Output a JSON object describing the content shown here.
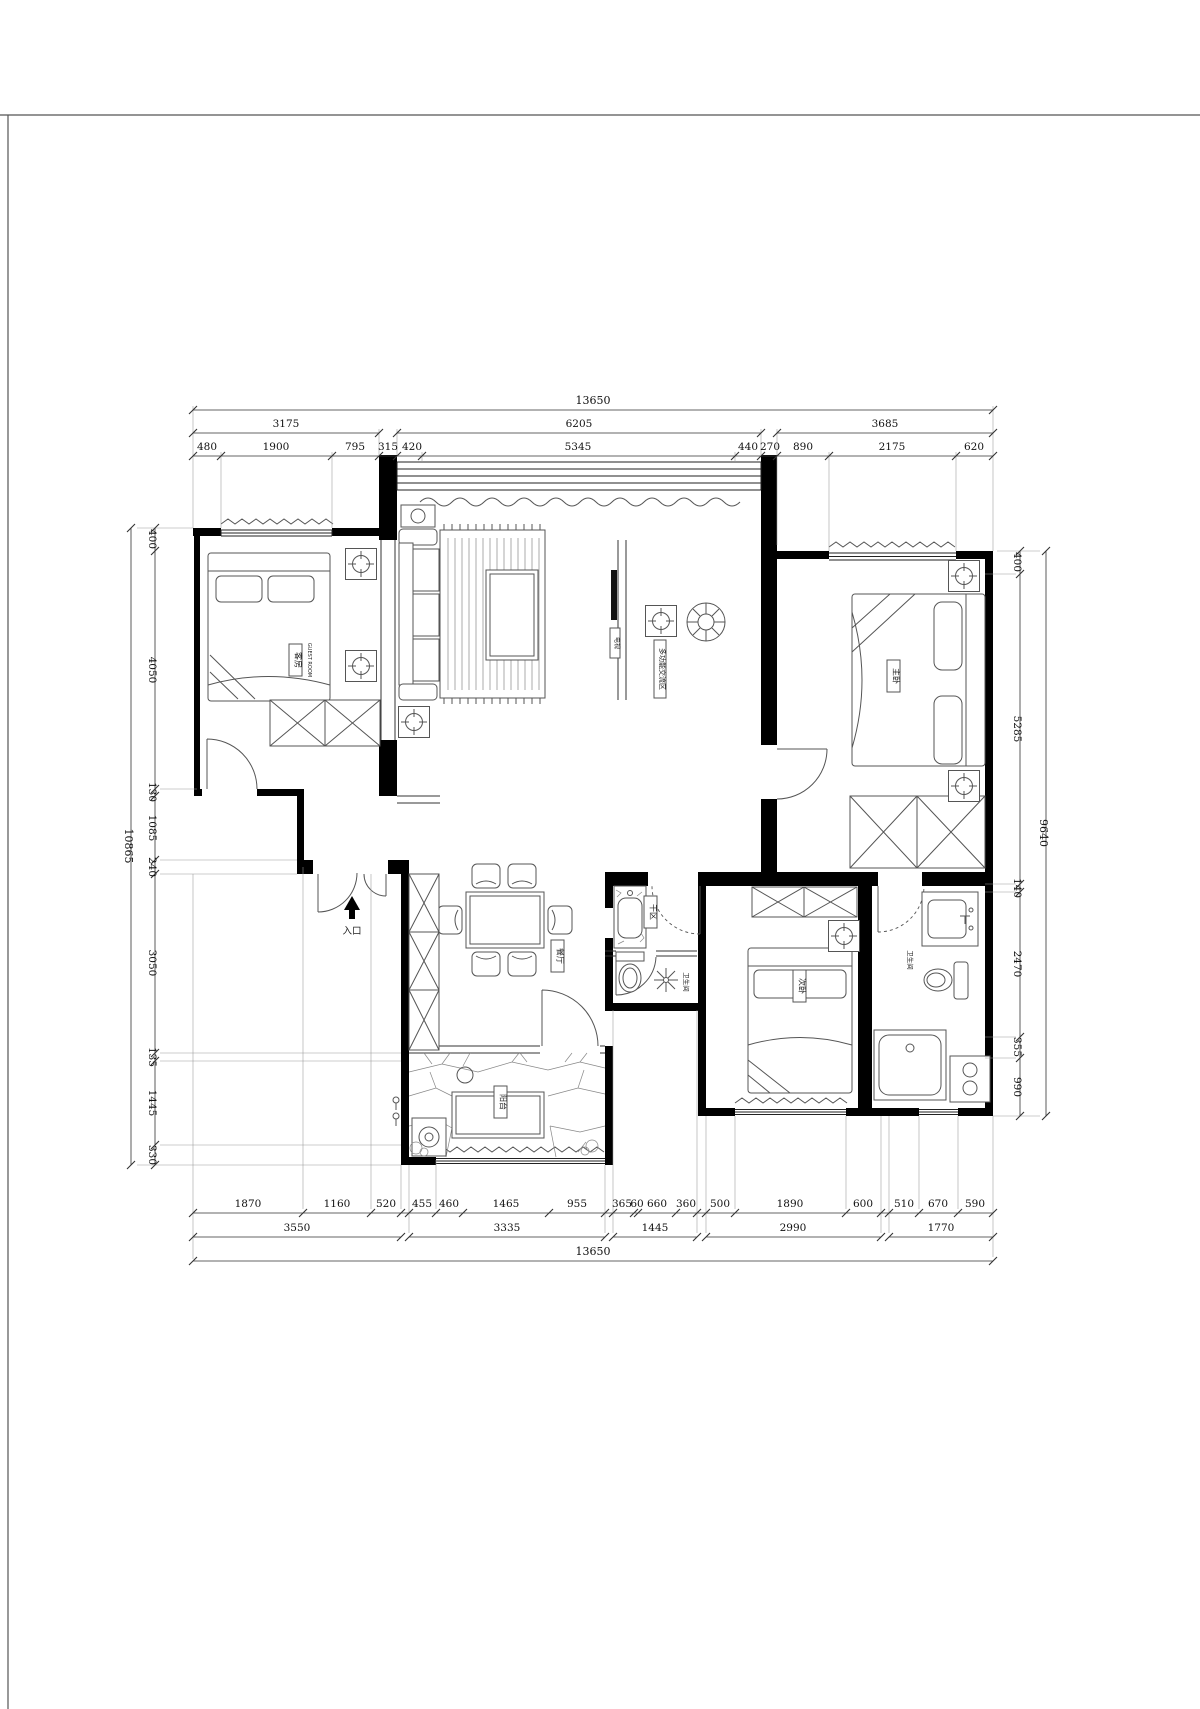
{
  "dims": {
    "top_overall": "13650",
    "top_groups": [
      "3175",
      "6205",
      "3685"
    ],
    "top_inner": [
      "480",
      "1900",
      "795",
      "315",
      "420",
      "5345",
      "440",
      "270",
      "890",
      "2175",
      "620"
    ],
    "bottom_inner": [
      "1870",
      "1160",
      "520",
      "455",
      "460",
      "1465",
      "955",
      "365",
      "60",
      "660",
      "360",
      "500",
      "1890",
      "600",
      "510",
      "670",
      "590"
    ],
    "bottom_groups": [
      "3550",
      "3335",
      "1445",
      "2990",
      "1770"
    ],
    "bottom_overall": "13650",
    "left_overall": "10865",
    "left_inner": [
      "400",
      "4050",
      "130",
      "1085",
      "240",
      "3050",
      "135",
      "1445",
      "330"
    ],
    "right_overall": "9640",
    "right_inner": [
      "400",
      "5285",
      "140",
      "2470",
      "355",
      "990"
    ]
  },
  "rooms": {
    "guest": "客房",
    "guest_en": "GUEST ROOM",
    "living": "多功能交流区",
    "tv": "电视",
    "dining": "餐厅",
    "dry_area": "干区",
    "bathroom": "卫生间",
    "master_bathroom": "卫生间",
    "secondary_bedroom": "次卧",
    "master_bedroom": "主卧",
    "balcony": "阳台",
    "entrance": "入口"
  }
}
